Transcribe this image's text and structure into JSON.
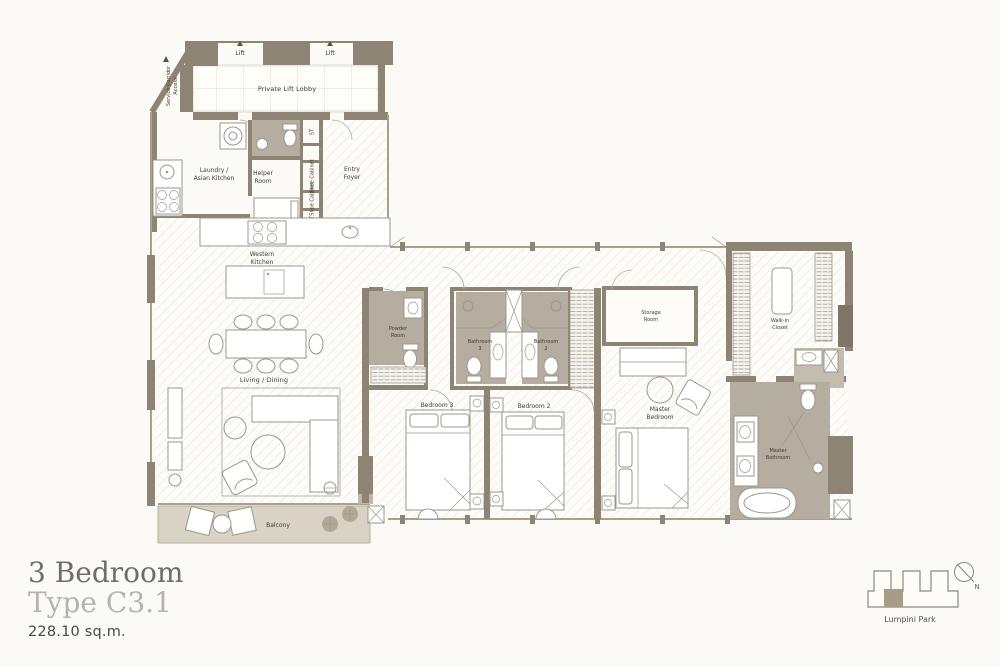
{
  "palette": {
    "wall": "#8d8474",
    "wall-dark": "#7e7565",
    "bath-floor": "#b5ada0",
    "bath-floor2": "#c3bcaf",
    "balcony": "#d9d3c5",
    "fix": "#9b978c",
    "label": "#3e3c36",
    "title": "#6f6d6a",
    "subtitle": "#b5b3af",
    "area": "#4b4944",
    "keyfill": "#a79d86",
    "glass": "#a89f8f"
  },
  "plan": {
    "labels": {
      "lift": "Lift",
      "private_lift_lobby": "Private Lift Lobby",
      "service_corridor_line1": "Service Corridor",
      "service_corridor_line2": "Access",
      "st": "ST",
      "shoe_cabinet": "Shoe Cabinet",
      "laundry_line1": "Laundry /",
      "laundry_line2": "Asian Kitchen",
      "helper_line1": "Helper",
      "helper_line2": "Room",
      "entry_line1": "Entry",
      "entry_line2": "Foyer",
      "western_line1": "Western",
      "western_line2": "Kitchen",
      "living_dining": "Living / Dining",
      "balcony": "Balcony",
      "powder_line1": "Powder",
      "powder_line2": "Room",
      "bedroom3": "Bedroom 3",
      "bathroom_word": "Bathroom",
      "bathroom3_num": "3",
      "bathroom2_num": "2",
      "bedroom2": "Bedroom 2",
      "storage_line1": "Storage",
      "storage_line2": "Room",
      "master_bed_line1": "Master",
      "master_bed_line2": "Bedroom",
      "walkin_line1": "Walk-in",
      "walkin_line2": "Closet",
      "master_bath_line1": "Master",
      "master_bath_line2": "Bathroom"
    }
  },
  "title": {
    "line1": "3 Bedroom",
    "line2": "Type C3.1",
    "area": "228.10 sq.m."
  },
  "keyplan": {
    "location": "Lumpini Park",
    "north": "N"
  }
}
